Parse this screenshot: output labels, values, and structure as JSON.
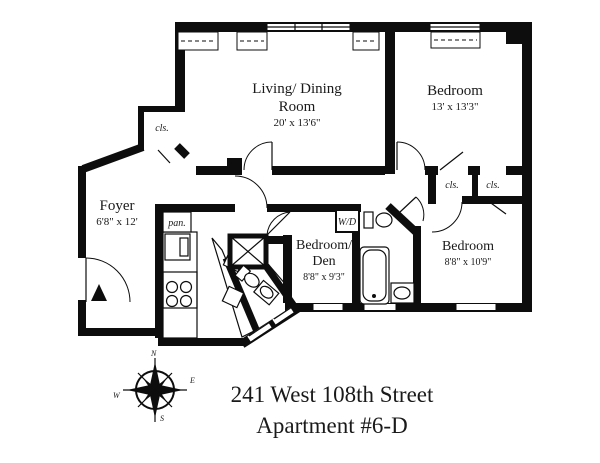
{
  "page": {
    "background": "#ffffff",
    "wall_color": "#0d0d0d",
    "text_color": "#1a1a1a"
  },
  "title": {
    "line1": "241 West 108th Street",
    "line2": "Apartment #6-D"
  },
  "rooms": {
    "living": {
      "name1": "Living/ Dining",
      "name2": "Room",
      "dims": "20' x 13'6\""
    },
    "bedroom_top": {
      "name": "Bedroom",
      "dims": "13' x 13'3\""
    },
    "foyer": {
      "name": "Foyer",
      "dims": "6'8\" x 12'"
    },
    "bedroom_den": {
      "name1": "Bedroom/",
      "name2": "Den",
      "dims": "8'8\" x 9'3\""
    },
    "bedroom_right": {
      "name": "Bedroom",
      "dims": "8'8\" x 10'9\""
    }
  },
  "labels": {
    "closet_top_left": "cls.",
    "closet_mid_left": "cls.",
    "closet_mid_right": "cls.",
    "pantry": "pan.",
    "washer_dryer": "W/D"
  },
  "compass": {
    "n": "N",
    "e": "E",
    "s": "S",
    "w": "W"
  }
}
